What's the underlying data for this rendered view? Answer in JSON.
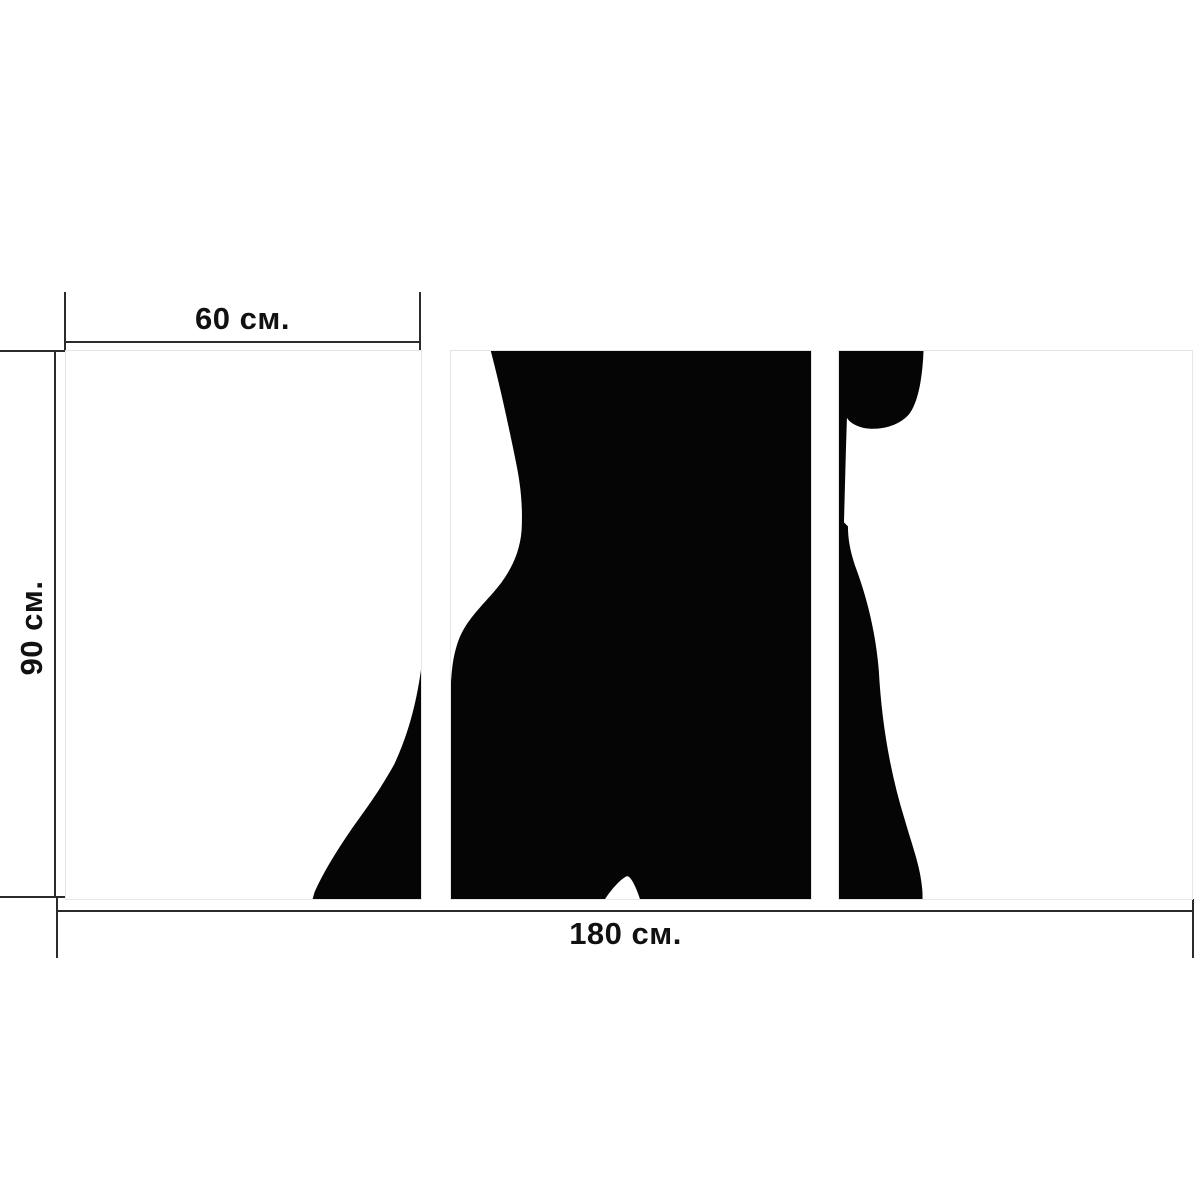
{
  "dimensions": {
    "panel_width_label": "60 см.",
    "height_label": "90 см.",
    "total_width_label": "180 см."
  },
  "colors": {
    "silhouette": "#050505",
    "dimension_line": "#2b2b2b",
    "panel_border": "#e7e7ea",
    "background": "#ffffff"
  },
  "silhouette": {
    "panel1_path": "M357,320 C352,355 344,385 330,415 C312,447 298,464 285,483 C270,505 258,525 250,543 L248,550 L357,550 Z",
    "panel2_path": "M40,0 C48,30 58,75 66,115 C71,140 72,160 71,180 C69,205 58,225 42,243 C25,262 12,275 6,295 C2,308 1,318 0,332 L0,550 L155,550 C160,542 170,530 177,527 C181,527 186,538 190,550 L362,550 L362,0 Z",
    "panel3_path": "M0,0 L85,0 C84,25 80,52 70,64 C58,77 38,80 24,77 C16,75 10,71 8,67 C7,95 6,135 5,172 L9,176 C9,188 11,200 16,215 C26,242 36,275 40,320 C43,375 52,425 66,470 C74,498 83,520 84,545 L84,550 L0,550 Z"
  }
}
